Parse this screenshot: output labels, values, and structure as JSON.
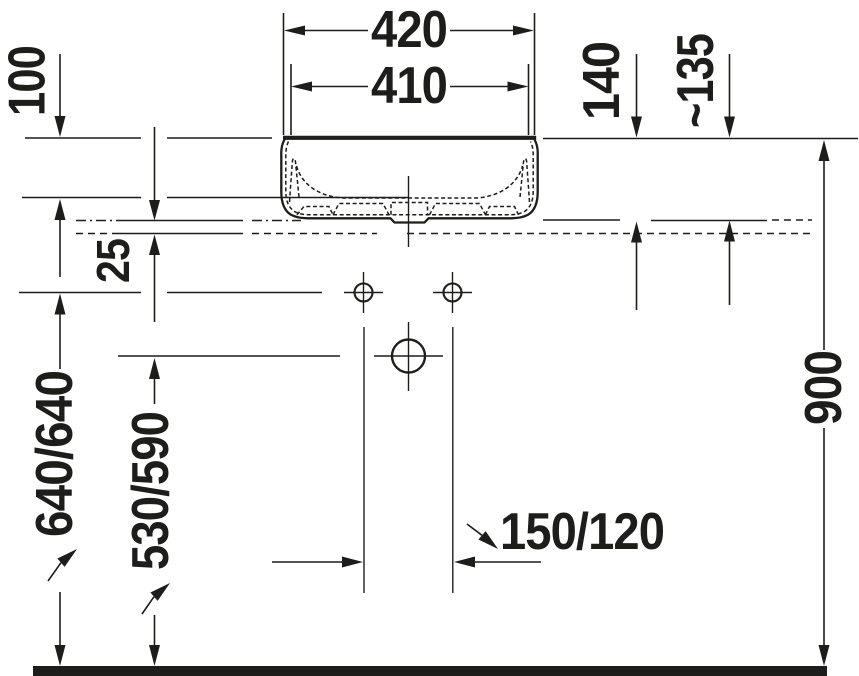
{
  "page": {
    "background": "#ffffff",
    "ink_color": "#1d1d1b"
  },
  "drawing": {
    "type": "technical-installation-drawing",
    "subject": "countertop washbasin front elevation with mounting dimensions",
    "units": "mm",
    "labels": {
      "width_outer": "420",
      "width_inner": "410",
      "bowl_depth": "100",
      "height_above_counter": "140",
      "height_above_counter_approx": "~135",
      "counter_offset": "25",
      "rim_height_from_floor": "640/640",
      "outlet_height_from_floor": "530/590",
      "tap_hole_distance": "150/120",
      "counter_height_from_floor": "900"
    }
  }
}
